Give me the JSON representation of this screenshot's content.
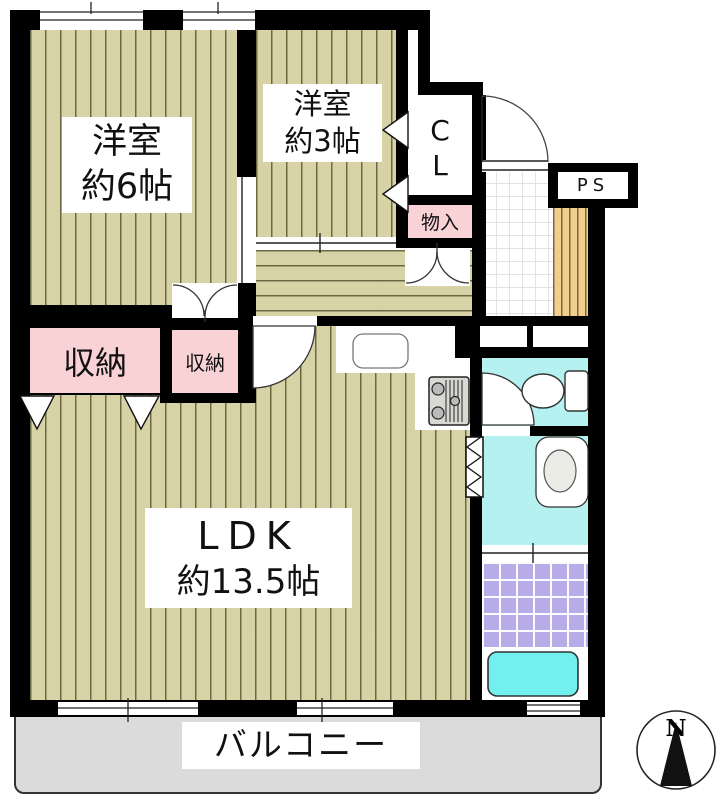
{
  "floorplan": {
    "rooms": {
      "bedroom6": {
        "name": "洋室",
        "size": "約6帖"
      },
      "bedroom3": {
        "name": "洋室",
        "size": "約3帖"
      },
      "ldk": {
        "name": "LDK",
        "size": "約13.5帖"
      },
      "closet_large": {
        "label": "収納"
      },
      "closet_small": {
        "label": "収納"
      },
      "storage": {
        "label": "物入"
      },
      "closet_cl": {
        "letter1": "C",
        "letter2": "L"
      },
      "pipe_space": {
        "label": "PS"
      },
      "balcony": {
        "label": "バルコニー"
      }
    },
    "compass": {
      "north": "N"
    },
    "fixtures": [
      "kitchen-sink",
      "gas-stove",
      "toilet",
      "washbasin",
      "bathtub",
      "entrance-door",
      "accordion-door",
      "compass-north-arrow"
    ],
    "colors": {
      "wall": "#000000",
      "floor": "#D8D3A6",
      "closet_pink": "#F8D2D5",
      "wet_area_cyan": "#B5F1F1",
      "bathtub_cyan": "#72EFEF",
      "bath_tile_purple": "#B7ABE8",
      "shoe_cabinet_wood": "#EFCE8E",
      "balcony_gray": "#DBDBDB"
    }
  }
}
